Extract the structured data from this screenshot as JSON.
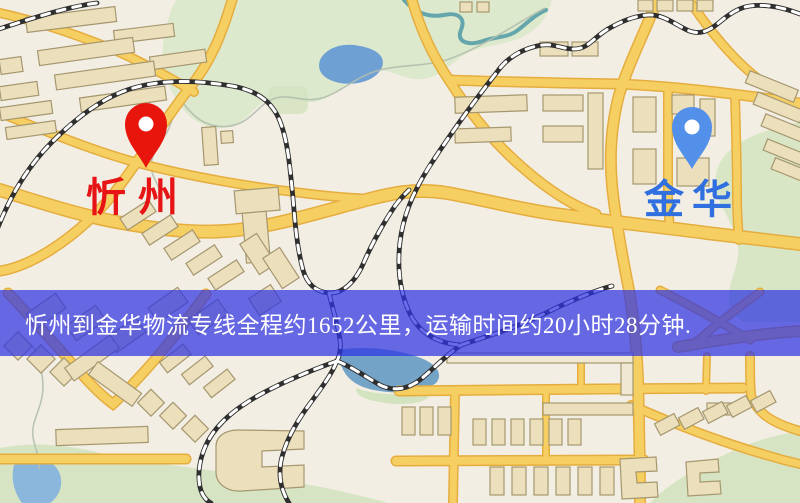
{
  "window": {
    "width": 800,
    "height": 503
  },
  "map": {
    "type": "road-map",
    "markers": [
      {
        "id": "origin",
        "label": "忻州",
        "pin_color": "#e8150d",
        "label_color": "#e61414"
      },
      {
        "id": "destination",
        "label": "金华",
        "pin_color": "#5290e9",
        "label_color": "#2f6fe0"
      }
    ],
    "banner": {
      "text": "忻州到金华物流专线全程约1652公里，运输时间约20小时28分钟.",
      "background": "#2e33e3",
      "opacity": 0.72,
      "text_color": "#ffffff"
    },
    "route": {
      "origin": "忻州",
      "destination": "金华",
      "line_type": "物流专线",
      "distance_text": "约1652公里",
      "duration_text": "约20小时28分钟"
    }
  },
  "palette": {
    "background": "#f3eee3",
    "road_fill": "#f6cf63",
    "road_casing": "#e5ad3e",
    "building_fill": "#ecdfbc",
    "building_outline": "#a5976f",
    "park_green": "#dde9cd",
    "water_blue": "#74a3c8",
    "railway_dark": "#2f2f2f",
    "railway_light": "#ffffff"
  }
}
